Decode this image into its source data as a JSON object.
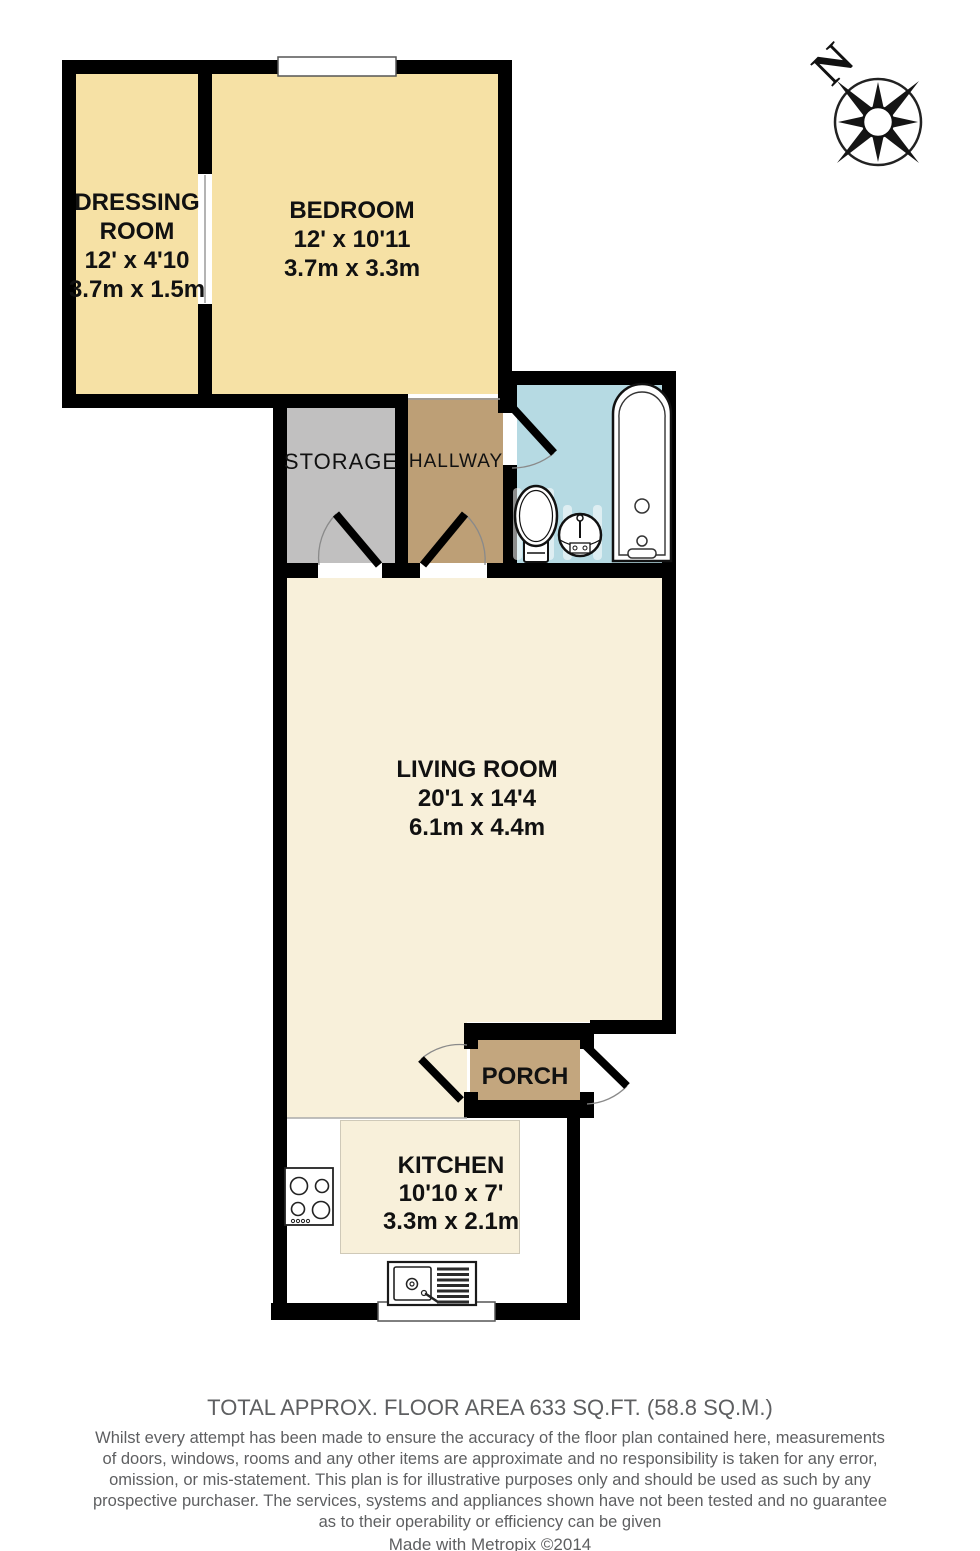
{
  "rooms": {
    "dressing": {
      "line1": "DRESSING",
      "line2": "ROOM",
      "imperial": "12' x 4'10",
      "metric": "3.7m x 1.5m"
    },
    "bedroom": {
      "line1": "BEDROOM",
      "imperial": "12' x 10'11",
      "metric": "3.7m x 3.3m"
    },
    "storage": {
      "line1": "STORAGE"
    },
    "hallway": {
      "line1": "HALLWAY"
    },
    "living_room": {
      "line1": "LIVING ROOM",
      "imperial": "20'1 x 14'4",
      "metric": "6.1m x 4.4m"
    },
    "porch": {
      "line1": "PORCH"
    },
    "kitchen": {
      "line1": "KITCHEN",
      "imperial": "10'10 x 7'",
      "metric": "3.3m x 2.1m"
    }
  },
  "compass": {
    "north_label": "N"
  },
  "footer": {
    "total_area": "TOTAL APPROX. FLOOR AREA 633 SQ.FT. (58.8 SQ.M.)",
    "disclaimer_lines": [
      "Whilst every attempt has been made to ensure the accuracy of the floor plan contained here, measurements",
      "of doors, windows, rooms and any other items are approximate and no responsibility is taken for any error,",
      "omission, or mis-statement. This plan is for illustrative purposes only and should be used as such by any",
      "prospective purchaser. The services, systems and appliances shown have not been tested and no guarantee",
      "as to their operability or efficiency can be given"
    ],
    "credit": "Made with Metropix ©2014"
  },
  "colors": {
    "bedroom_yellow": "#F6E1A5",
    "floor_cream": "#F8F0DA",
    "hallway_brown": "#BD9F76",
    "porch_brown": "#C3A67E",
    "storage_grey": "#C1C0C0",
    "bathroom_blue": "#B6DAE3",
    "wall_black": "#000000",
    "footer_grey": "#5E5F61"
  }
}
